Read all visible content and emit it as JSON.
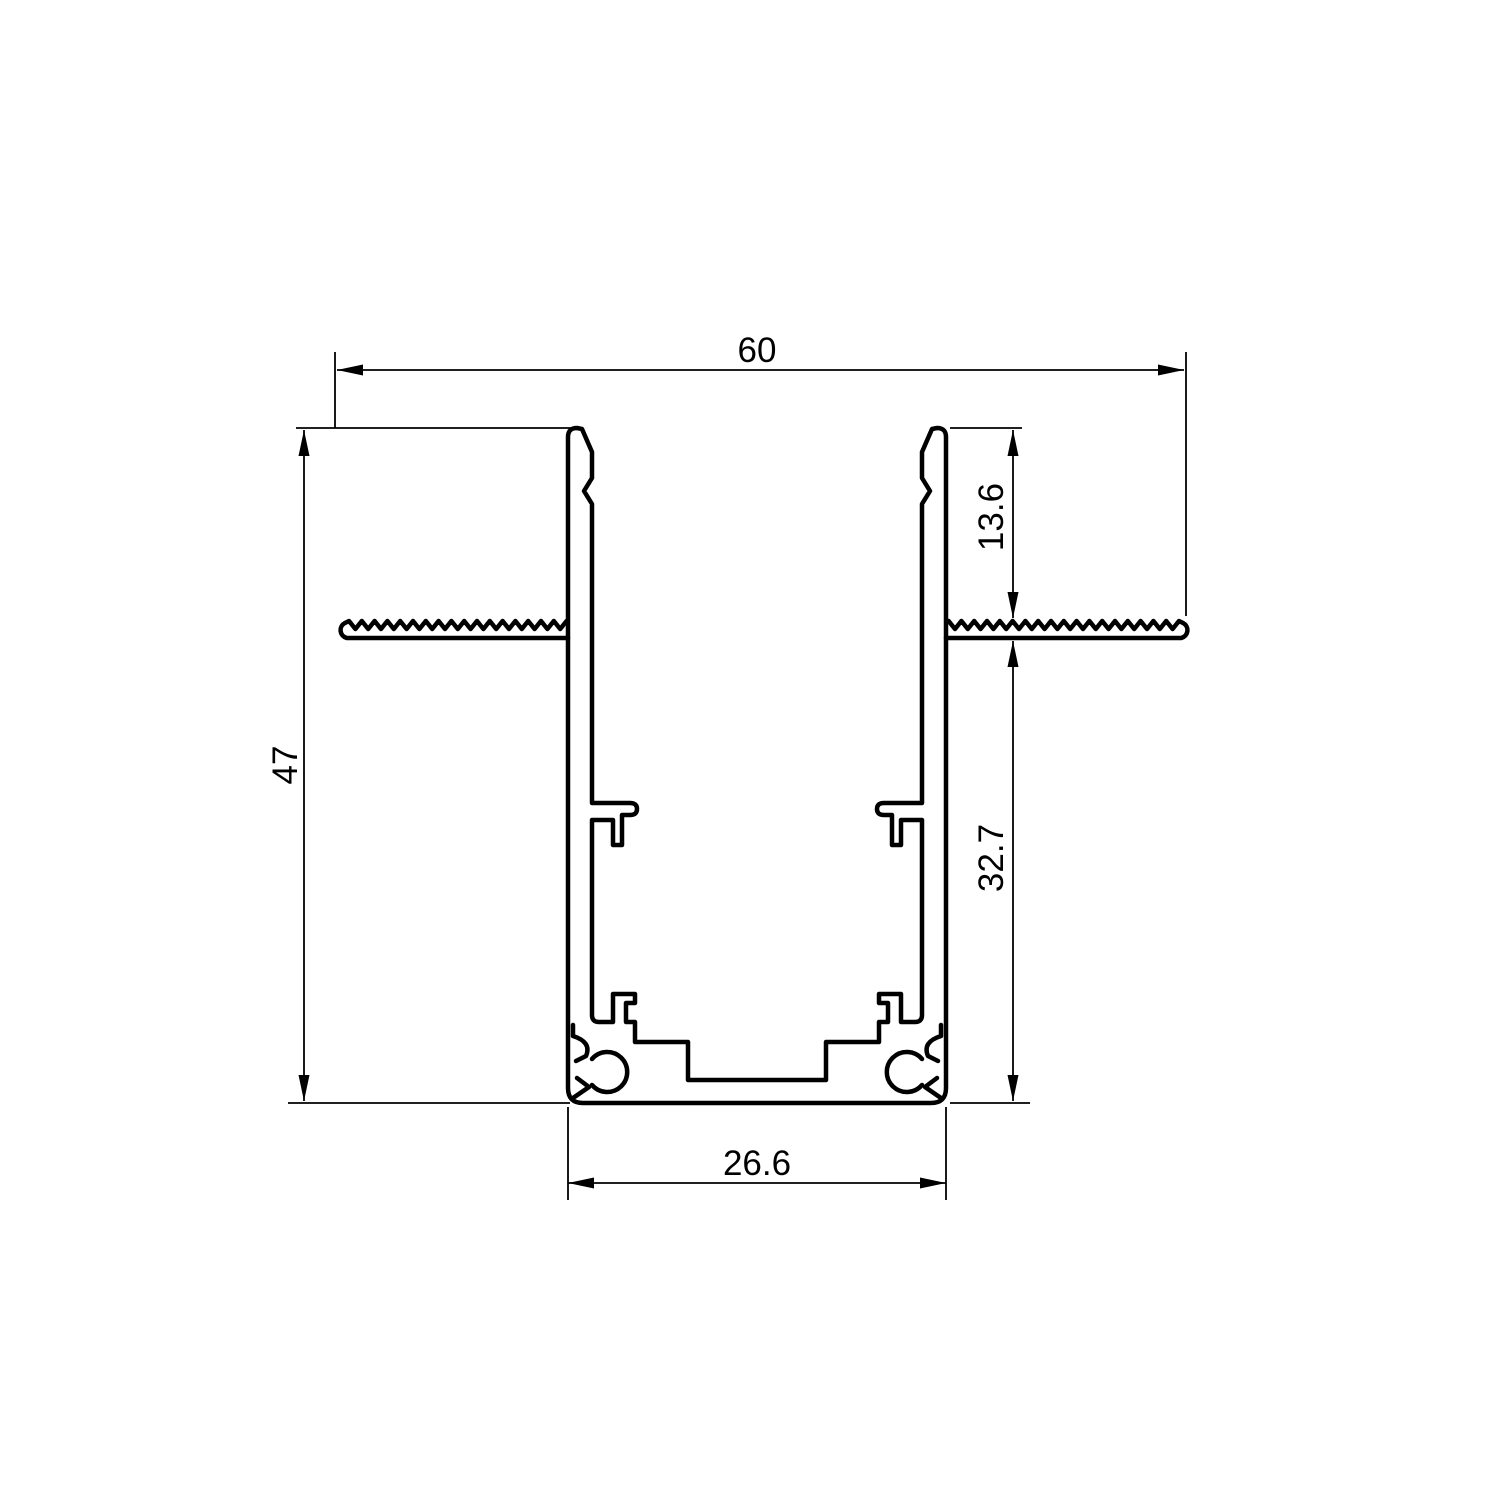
{
  "drawing": {
    "title": "aluminium recessed track profile cross-section",
    "background_color": "#ffffff",
    "line_color": "#000000",
    "dimensions": {
      "overall_width": "60",
      "overall_height": "47",
      "flange_depth": "13.6",
      "body_depth": "32.7",
      "base_width": "26.6"
    }
  }
}
